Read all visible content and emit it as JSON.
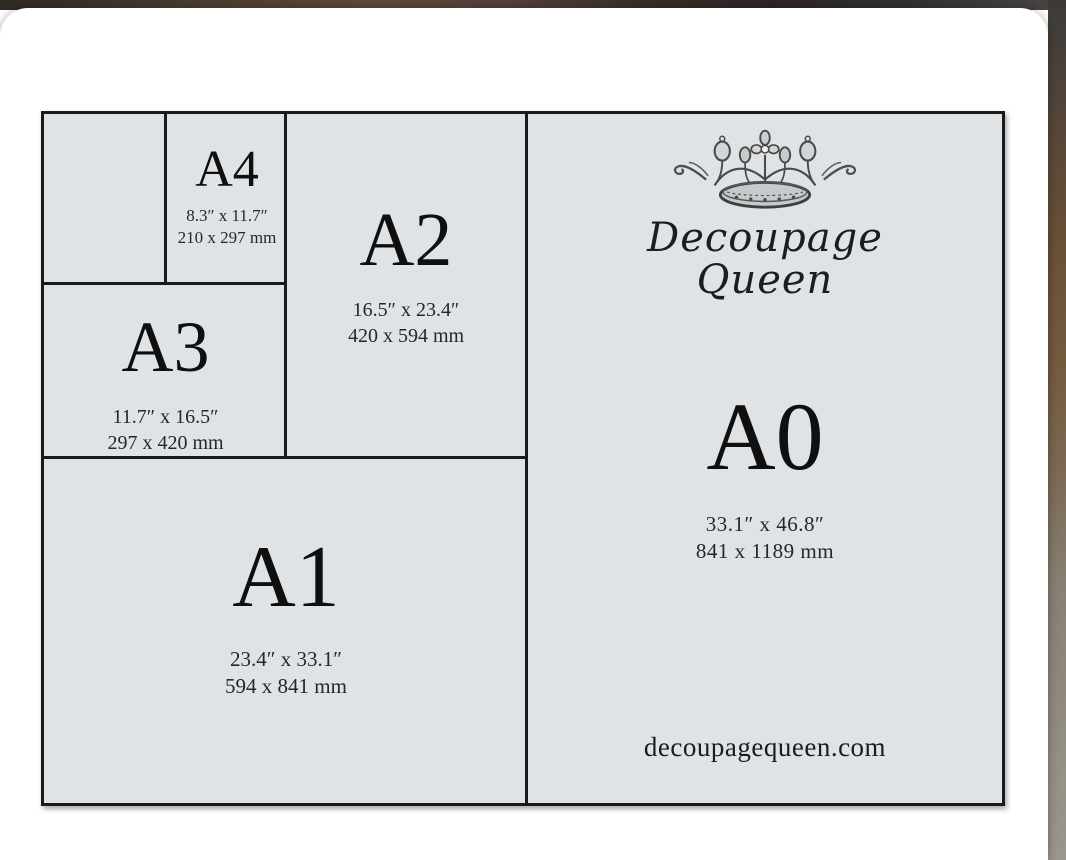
{
  "brand": {
    "name_line1": "Decoupage",
    "name_line2": "Queen",
    "website": "decoupagequeen.com"
  },
  "chart": {
    "title_implicit": "A-series paper size comparison",
    "sizes": [
      {
        "label": "A4",
        "inches": "8.3″ x 11.7″",
        "mm": "210 x 297 mm"
      },
      {
        "label": "A3",
        "inches": "11.7″ x 16.5″",
        "mm": "297 x 420 mm"
      },
      {
        "label": "A2",
        "inches": "16.5″ x 23.4″",
        "mm": "420 x 594 mm"
      },
      {
        "label": "A1",
        "inches": "23.4″ x 33.1″",
        "mm": "594 x 841 mm"
      },
      {
        "label": "A0",
        "inches": "33.1″ x 46.8″",
        "mm": "841 x 1189 mm"
      }
    ]
  },
  "colors": {
    "panel_bg": "#dfe3e6",
    "line": "#1a1a1a",
    "card_bg": "#ffffff",
    "backdrop_brown": "#6b5138"
  }
}
